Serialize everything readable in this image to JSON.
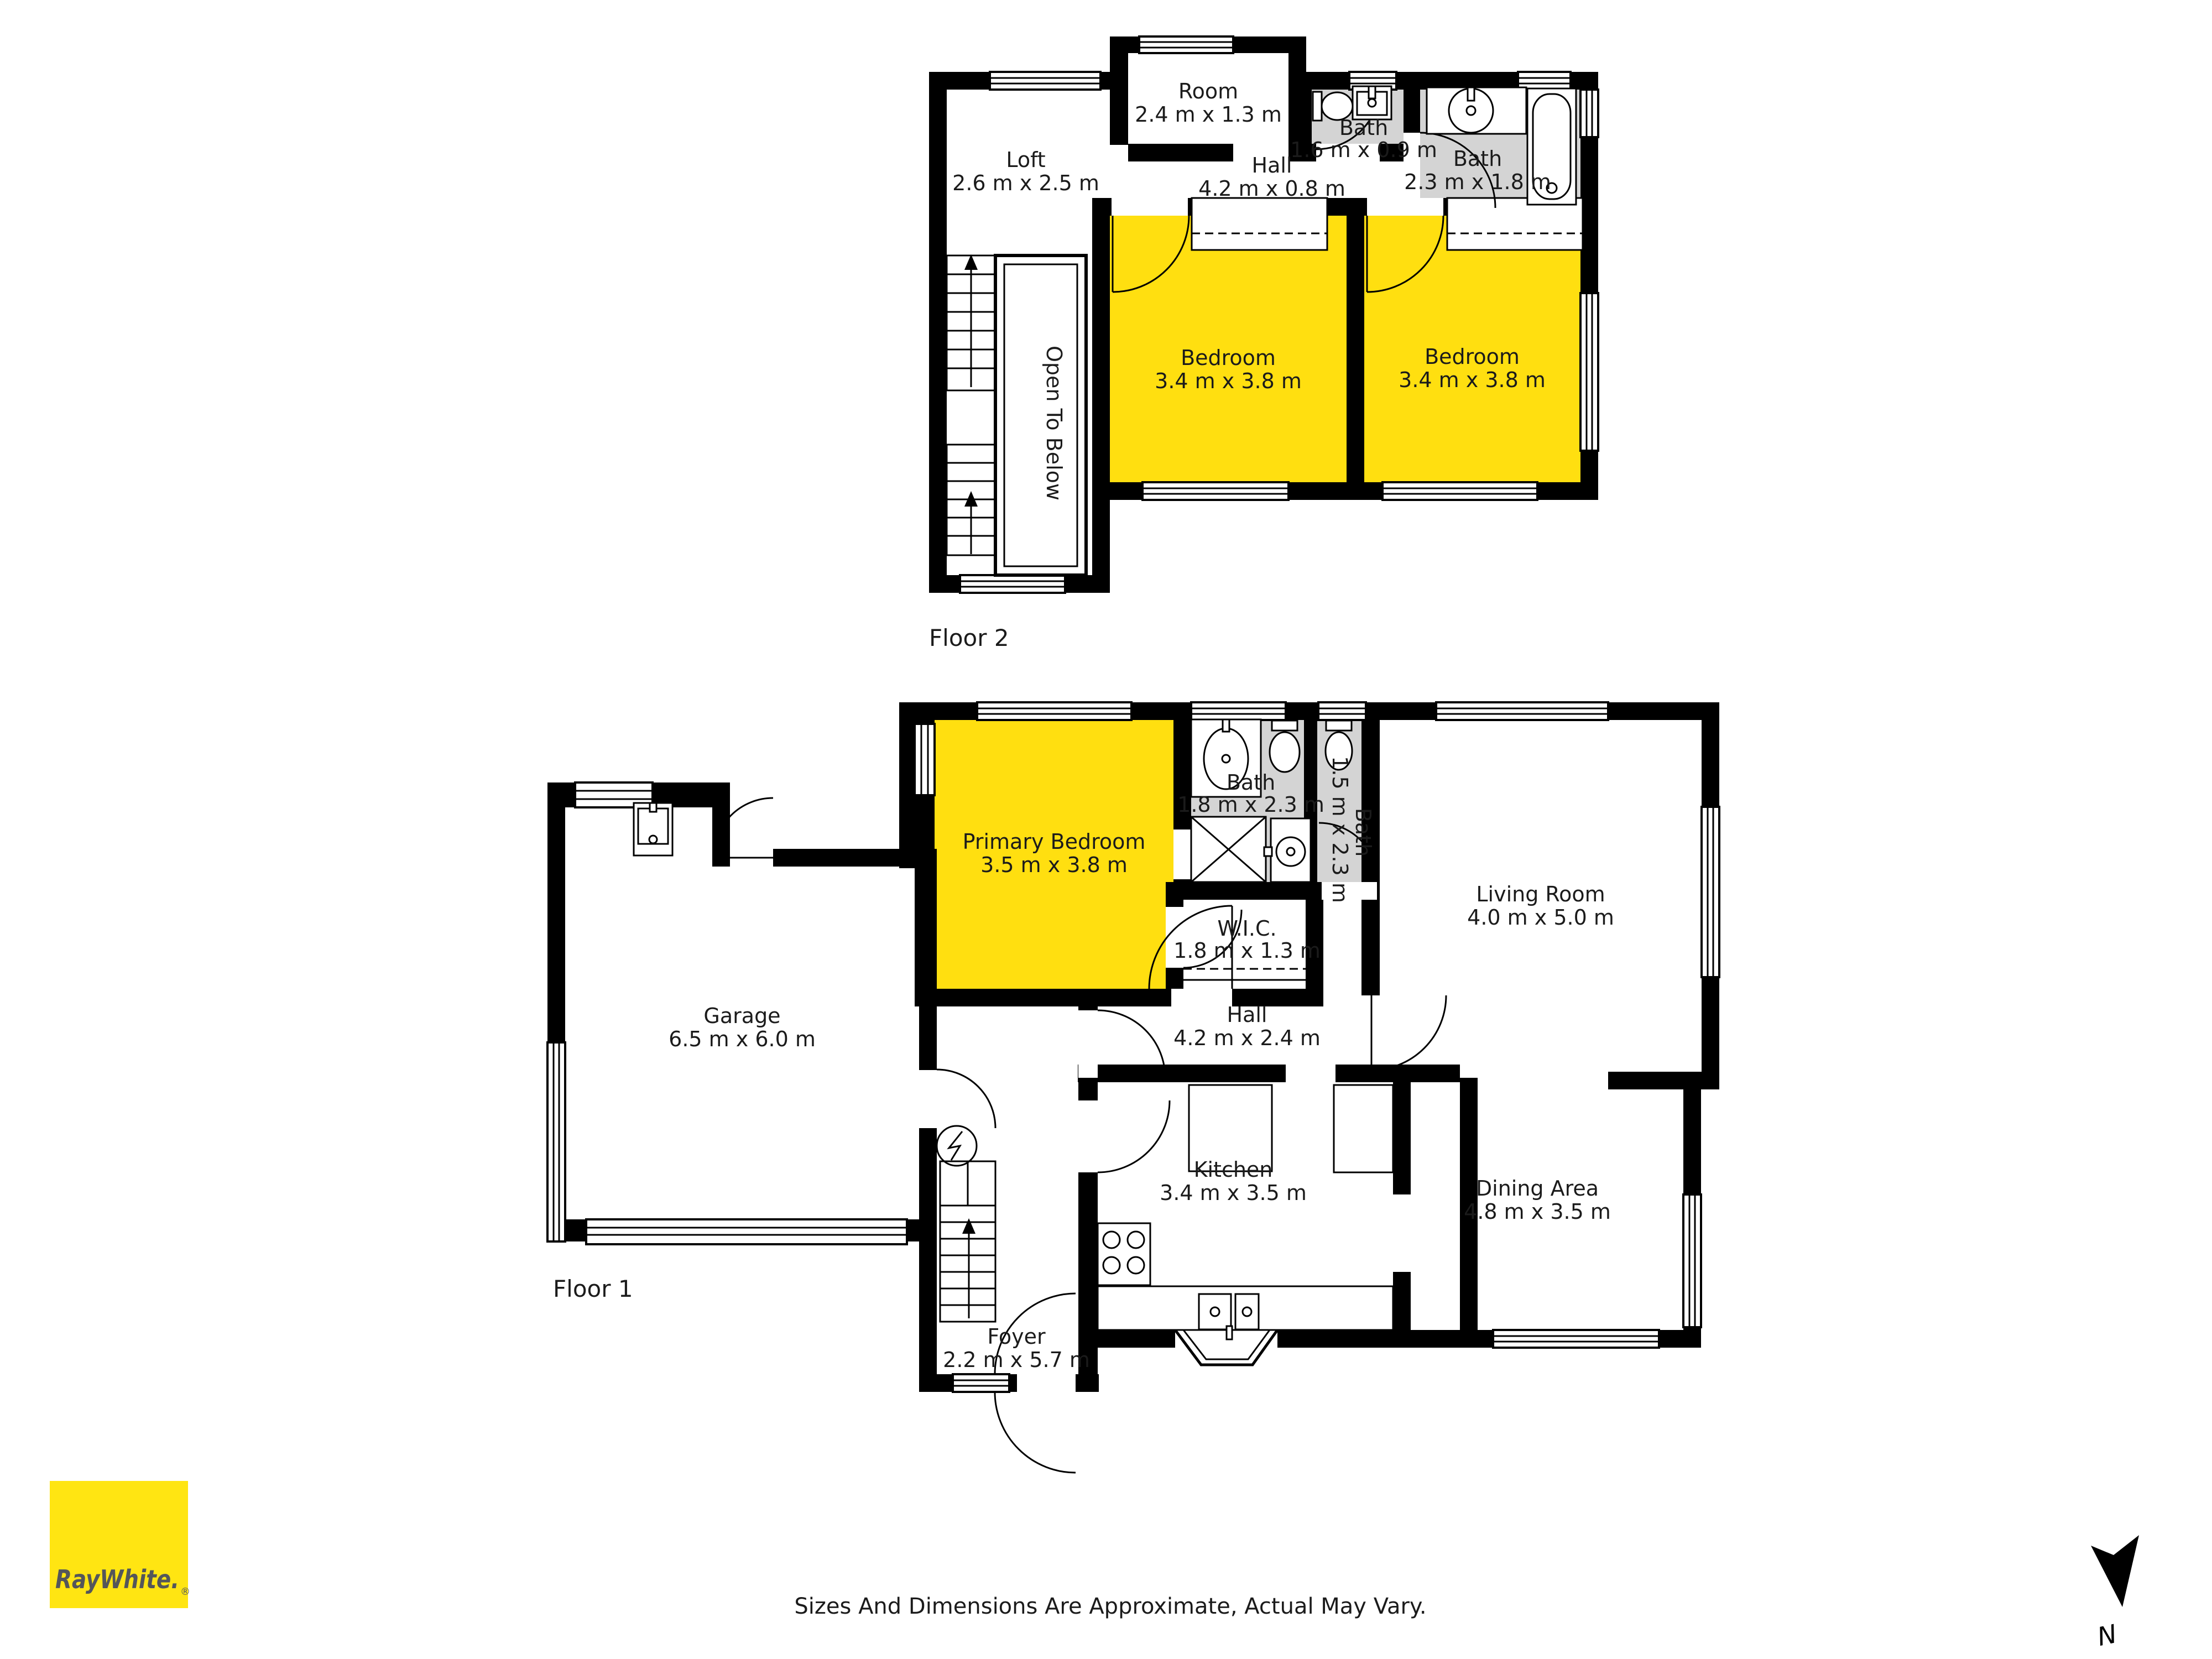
{
  "floor2": {
    "label": "Floor 2",
    "open_to_below": "Open To Below",
    "rooms": {
      "loft": {
        "name": "Loft",
        "dims": "2.6 m x 2.5 m"
      },
      "room": {
        "name": "Room",
        "dims": "2.4 m x 1.3 m"
      },
      "hall": {
        "name": "Hall",
        "dims": "4.2 m x 0.8 m"
      },
      "bath_small": {
        "name": "Bath",
        "dims": "1.6 m x 0.9 m"
      },
      "bath": {
        "name": "Bath",
        "dims": "2.3 m x 1.8 m"
      },
      "bedroom_left": {
        "name": "Bedroom",
        "dims": "3.4 m x 3.8 m"
      },
      "bedroom_right": {
        "name": "Bedroom",
        "dims": "3.4 m x 3.8 m"
      }
    }
  },
  "floor1": {
    "label": "Floor 1",
    "rooms": {
      "garage": {
        "name": "Garage",
        "dims": "6.5 m x 6.0 m"
      },
      "primary_bedroom": {
        "name": "Primary Bedroom",
        "dims": "3.5 m x 3.8 m"
      },
      "bath": {
        "name": "Bath",
        "dims": "1.8 m x 2.3 m"
      },
      "bath_narrow": {
        "name": "Bath",
        "dims": "1.5 m x 2.3 m"
      },
      "wic": {
        "name": "W.I.C.",
        "dims": "1.8 m x 1.3 m"
      },
      "hall": {
        "name": "Hall",
        "dims": "4.2 m x 2.4 m"
      },
      "living_room": {
        "name": "Living Room",
        "dims": "4.0 m x 5.0 m"
      },
      "kitchen": {
        "name": "Kitchen",
        "dims": "3.4 m x 3.5 m"
      },
      "dining_area": {
        "name": "Dining Area",
        "dims": "4.8 m x 3.5 m"
      },
      "foyer": {
        "name": "Foyer",
        "dims": "2.2 m x 5.7 m"
      }
    }
  },
  "footer": {
    "disclaimer": "Sizes And Dimensions Are Approximate, Actual May Vary."
  },
  "branding": {
    "logo_text": "RayWhite.",
    "registered": "®"
  },
  "compass": {
    "north_label": "N"
  },
  "colors": {
    "room_highlight": "#ffdf10",
    "bath_gray": "#d4d4d4",
    "logo_yellow": "#ffe512",
    "wall": "#000000"
  }
}
